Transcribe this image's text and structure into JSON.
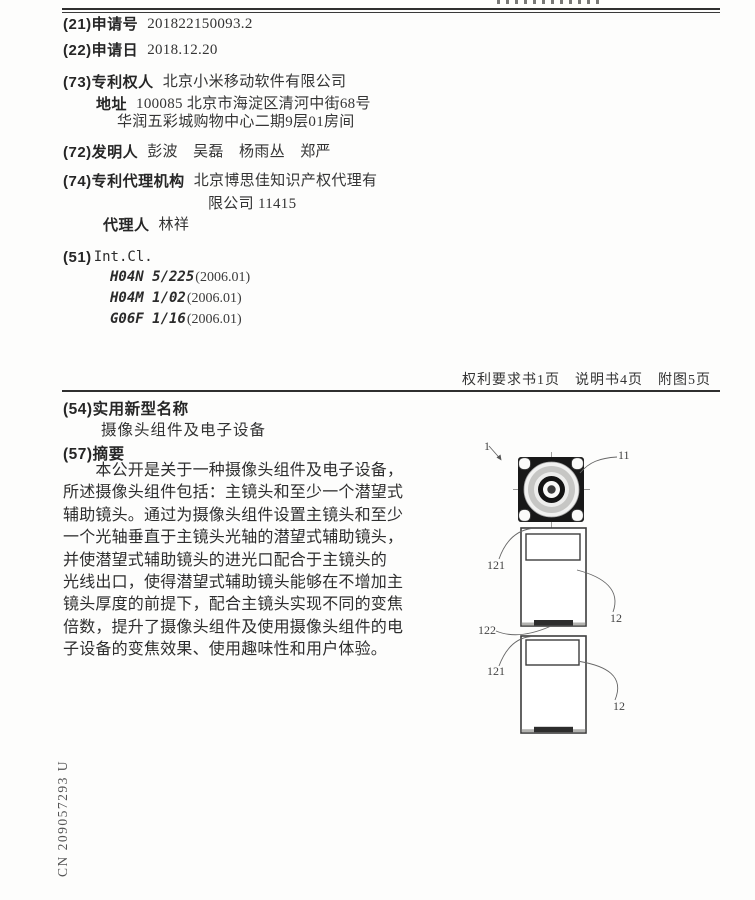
{
  "document": {
    "sidebar_number": "CN 209057293 U",
    "pages_info": "权利要求书1页　说明书4页　附图5页"
  },
  "biblio": {
    "app_no": {
      "label": "(21)申请号",
      "value": "201822150093.2"
    },
    "app_date": {
      "label": "(22)申请日",
      "value": "2018.12.20"
    },
    "patentee": {
      "label": "(73)专利权人",
      "value": "北京小米移动软件有限公司"
    },
    "address": {
      "label": "地址",
      "value": "100085 北京市海淀区清河中街68号"
    },
    "address2": "华润五彩城购物中心二期9层01房间",
    "inventors": {
      "label": "(72)发明人",
      "value": "彭波　吴磊　杨雨丛　郑严"
    },
    "agency": {
      "label": "(74)专利代理机构",
      "value": "北京博思佳知识产权代理有"
    },
    "agency2": "限公司 11415",
    "agent": {
      "label": "代理人",
      "value": "林祥"
    },
    "intcl": {
      "label_num": "(51)",
      "label_name": "Int.Cl.",
      "e0": {
        "code": "H04N 5/225",
        "ver": "(2006.01)"
      },
      "e1": {
        "code": "H04M 1/02",
        "ver": "(2006.01)"
      },
      "e2": {
        "code": "G06F 1/16",
        "ver": "(2006.01)"
      }
    }
  },
  "sections": {
    "title": {
      "label": "(54)实用新型名称",
      "text": "摄像头组件及电子设备"
    },
    "abstract": {
      "label": "(57)摘要",
      "text": "　　本公开是关于一种摄像头组件及电子设备，\n所述摄像头组件包括：主镜头和至少一个潜望式\n辅助镜头。通过为摄像头组件设置主镜头和至少\n一个光轴垂直于主镜头光轴的潜望式辅助镜头，\n并使潜望式辅助镜头的进光口配合于主镜头的\n光线出口，使得潜望式辅助镜头能够在不增加主\n镜头厚度的前提下，配合主镜头实现不同的变焦\n倍数，提升了摄像头组件及使用摄像头组件的电\n子设备的变焦效果、使用趣味性和用户体验。"
    }
  },
  "figure": {
    "label_1": "1",
    "label_11": "11",
    "label_121_top": "121",
    "label_12_top": "12",
    "label_122": "122",
    "label_121_bottom": "121",
    "label_12_bottom": "12"
  }
}
